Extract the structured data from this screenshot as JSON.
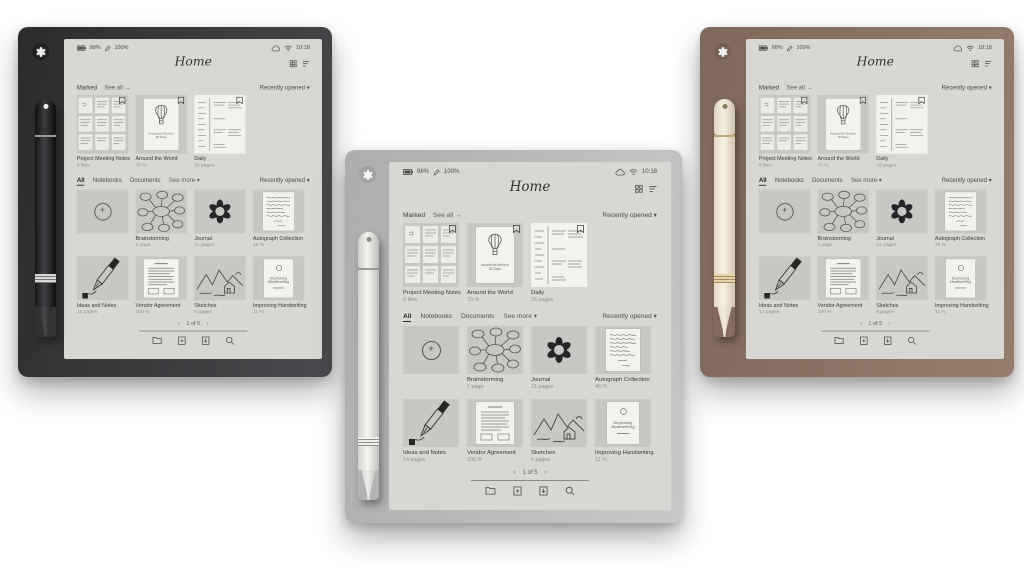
{
  "product": {
    "tablets": [
      {
        "id": "black-tablet",
        "frame_color": "#3a3a3e",
        "pen": "black-pen"
      },
      {
        "id": "silver-tablet",
        "frame_color": "#bcbbbb",
        "pen": "white-pen"
      },
      {
        "id": "brown-tablet",
        "frame_color": "#8a7262",
        "pen": "cream-pen"
      }
    ]
  },
  "screen": {
    "status": {
      "battery": "98%",
      "pen_battery": "100%",
      "time": "10:18"
    },
    "title": "Home",
    "marked": {
      "label": "Marked",
      "see_all": "See all →",
      "sort": "Recently opened ▾",
      "items": [
        {
          "title": "Project Meeting Notes",
          "meta": "8 files"
        },
        {
          "title": "Around the World",
          "meta": "70 %"
        },
        {
          "title": "Daily",
          "meta": "26 pages"
        }
      ]
    },
    "library": {
      "tabs": [
        "All",
        "Notebooks",
        "Documents"
      ],
      "see_more": "See more ▾",
      "sort": "Recently opened ▾",
      "items": [
        {
          "title": "Brainstorming",
          "meta": "1 page"
        },
        {
          "title": "Journal",
          "meta": "21 pages"
        },
        {
          "title": "Autograph Collection",
          "meta": "46 %"
        },
        {
          "title": "Ideas and Notes",
          "meta": "14 pages"
        },
        {
          "title": "Vendor Agreement",
          "meta": "100 %"
        },
        {
          "title": "Sketches",
          "meta": "6 pages"
        },
        {
          "title": "Improving Handwriting",
          "meta": "11 %"
        }
      ]
    },
    "thumbs": {
      "balloon_caption": "Around the World in 80 Days",
      "improving_caption": "Improving Handwriting"
    },
    "pagination": {
      "prev": "‹",
      "label": "1 of 5",
      "next": "›"
    }
  },
  "icons": {
    "new_notebook_plus": "+",
    "status_left": [
      "battery-icon",
      "pen-battery-icon"
    ],
    "status_right": [
      "cloud-sync-icon",
      "wifi-icon"
    ],
    "title_right": [
      "grid-view-icon",
      "sort-list-icon"
    ],
    "toolbar": [
      "folder-icon",
      "new-notebook-icon",
      "import-icon",
      "search-icon"
    ],
    "marked_corner": "bookmark-flag-icon"
  },
  "colors": {
    "screen_bg": "#d8d7d3",
    "thumb_bg": "#c8c7c3",
    "page_bg": "#f3f2ef",
    "text": "#3f3f3d",
    "muted": "#90908c",
    "frame_black": "#3a3a3e",
    "frame_silver": "#bcbbbb",
    "frame_brown": "#8a7262"
  }
}
